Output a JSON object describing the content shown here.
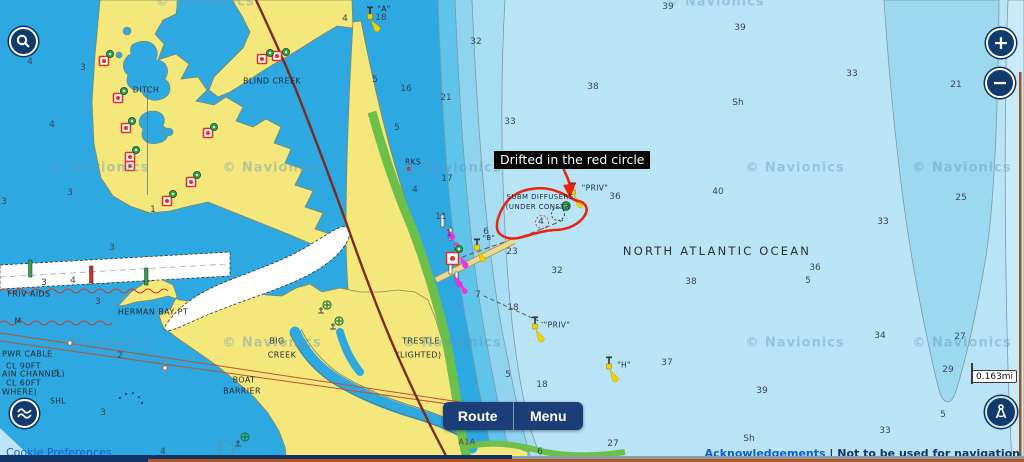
{
  "ui": {
    "zoom_in": "+",
    "zoom_out": "−",
    "route_label": "Route",
    "menu_label": "Menu",
    "cookie_label": "Cookie Preferences",
    "ack_link": "Acknowledgements",
    "separator": "|",
    "disclaimer": "Not to be used for navigation",
    "scale_value": "0.163",
    "scale_unit": "mi",
    "accent_navy": "#113a6d",
    "accent_orange": "#b5541f"
  },
  "annotation": {
    "label": "Drifted in the red circle",
    "color": "#e8230e"
  },
  "map": {
    "watermark_text": "© Navionics",
    "watermarks": [
      [
        205,
        2
      ],
      [
        715,
        2
      ],
      [
        100,
        168
      ],
      [
        272,
        168
      ],
      [
        452,
        168
      ],
      [
        795,
        168
      ],
      [
        962,
        168
      ],
      [
        100,
        343
      ],
      [
        272,
        343
      ],
      [
        452,
        343
      ],
      [
        795,
        343
      ],
      [
        962,
        343
      ]
    ],
    "soundings": [
      [
        30,
        62,
        "4"
      ],
      [
        83,
        68,
        "3"
      ],
      [
        52,
        125,
        "4"
      ],
      [
        70,
        193,
        "3"
      ],
      [
        4,
        202,
        "3"
      ],
      [
        153,
        210,
        "1"
      ],
      [
        112,
        248,
        "3"
      ],
      [
        44,
        283,
        "3"
      ],
      [
        73,
        281,
        "4"
      ],
      [
        98,
        302,
        "3"
      ],
      [
        120,
        356,
        "2"
      ],
      [
        57,
        374,
        "5"
      ],
      [
        103,
        413,
        "3"
      ],
      [
        163,
        452,
        "4"
      ],
      [
        345,
        19,
        "4"
      ],
      [
        381,
        18,
        "18"
      ],
      [
        668,
        7,
        "39"
      ],
      [
        476,
        42,
        "32"
      ],
      [
        375,
        80,
        "5"
      ],
      [
        406,
        89,
        "16"
      ],
      [
        446,
        98,
        "21"
      ],
      [
        593,
        87,
        "38"
      ],
      [
        740,
        28,
        "39"
      ],
      [
        852,
        74,
        "33"
      ],
      [
        738,
        103,
        "Sh"
      ],
      [
        956,
        85,
        "21"
      ],
      [
        510,
        122,
        "33"
      ],
      [
        397,
        128,
        "5"
      ],
      [
        447,
        179,
        "17"
      ],
      [
        415,
        190,
        "4"
      ],
      [
        441,
        217,
        "11"
      ],
      [
        449,
        234,
        "1"
      ],
      [
        541,
        222,
        "4"
      ],
      [
        615,
        197,
        "36"
      ],
      [
        718,
        192,
        "40"
      ],
      [
        961,
        198,
        "25"
      ],
      [
        883,
        222,
        "33"
      ],
      [
        486,
        232,
        "6"
      ],
      [
        512,
        252,
        "23"
      ],
      [
        557,
        271,
        "32"
      ],
      [
        691,
        282,
        "38"
      ],
      [
        478,
        295,
        "7"
      ],
      [
        513,
        308,
        "18"
      ],
      [
        508,
        375,
        "5"
      ],
      [
        542,
        385,
        "18"
      ],
      [
        667,
        363,
        "37"
      ],
      [
        613,
        444,
        "27"
      ],
      [
        540,
        452,
        "6"
      ],
      [
        815,
        268,
        "36"
      ],
      [
        808,
        281,
        "5"
      ],
      [
        880,
        336,
        "34"
      ],
      [
        960,
        337,
        "27"
      ],
      [
        948,
        370,
        "29"
      ],
      [
        762,
        391,
        "39"
      ],
      [
        943,
        415,
        "5"
      ],
      [
        885,
        431,
        "33"
      ],
      [
        749,
        439,
        "Sh"
      ]
    ],
    "places": [
      {
        "x": 146,
        "y": 90,
        "t": "DITCH"
      },
      {
        "x": 272,
        "y": 81,
        "t": "BLIND CREEK"
      },
      {
        "x": 384,
        "y": 9,
        "t": "\"A\"",
        "fs": 7.5
      },
      {
        "x": 413,
        "y": 162,
        "t": "RKS",
        "fs": 7.5
      },
      {
        "x": 29,
        "y": 294,
        "t": "FRIV AIDS"
      },
      {
        "x": 153,
        "y": 312,
        "t": "HERMAN BAY PT"
      },
      {
        "x": 18,
        "y": 321,
        "t": "M",
        "fs": 7.5
      },
      {
        "x": 58,
        "y": 401,
        "t": "SHL",
        "fs": 7.5
      },
      {
        "x": 277,
        "y": 341,
        "t": "BIG"
      },
      {
        "x": 282,
        "y": 355,
        "t": "CREEK"
      },
      {
        "x": 244,
        "y": 380,
        "t": "BOAT"
      },
      {
        "x": 242,
        "y": 391,
        "t": "BARRIER"
      },
      {
        "x": 421,
        "y": 341,
        "t": "TRESTLE"
      },
      {
        "x": 419,
        "y": 355,
        "t": "(LIGHTED)"
      },
      {
        "x": 489,
        "y": 238,
        "t": "\"B\"",
        "fs": 7
      },
      {
        "x": 540,
        "y": 197,
        "t": "SUBM DIFFUSERS",
        "fs": 7
      },
      {
        "x": 538,
        "y": 206.5,
        "t": "(UNDER CONSTR",
        "fs": 7
      },
      {
        "x": 595,
        "y": 188,
        "t": "\"PRIV\"",
        "fs": 7.5
      },
      {
        "x": 557,
        "y": 325,
        "t": "\"PRIV\"",
        "fs": 7.5
      },
      {
        "x": 624,
        "y": 365,
        "t": "\"H\"",
        "fs": 7.5
      },
      {
        "x": 467,
        "y": 442,
        "t": "A1A",
        "c": "#6b4a23"
      },
      {
        "x": 717,
        "y": 251,
        "t": "NORTH ATLANTIC OCEAN",
        "fs": 11.5,
        "ls": 2.2,
        "c": "#2c2c35"
      },
      {
        "x": 2,
        "y": 354,
        "t": "PWR CABLE",
        "left": 1
      },
      {
        "x": 6,
        "y": 366,
        "t": "CL 90FT",
        "left": 1
      },
      {
        "x": 2,
        "y": 374,
        "t": "AIN CHANNEL)",
        "left": 1
      },
      {
        "x": 6,
        "y": 383,
        "t": "CL 60FT",
        "left": 1
      },
      {
        "x": 2,
        "y": 392,
        "t": "WHERE)",
        "left": 1
      }
    ],
    "ocean_label": "NORTH ATLANTIC OCEAN",
    "colors": {
      "lagoon": "#2da8e0",
      "band2": "#5ec4ea",
      "band3": "#8fd3ef",
      "band4": "#a8def3",
      "ocean": "#b9e4f6",
      "trench": "#9dd8f1",
      "edge_strip": "#c9eaf8",
      "land": "#f4e77c",
      "shallow_green": "#6cbf48",
      "road": "#7c2b1d",
      "marker_red": "#e03227",
      "marker_green": "#2fa44d",
      "light_magenta": "#ef2fe0",
      "beacon_yellow": "#f5d000"
    }
  }
}
